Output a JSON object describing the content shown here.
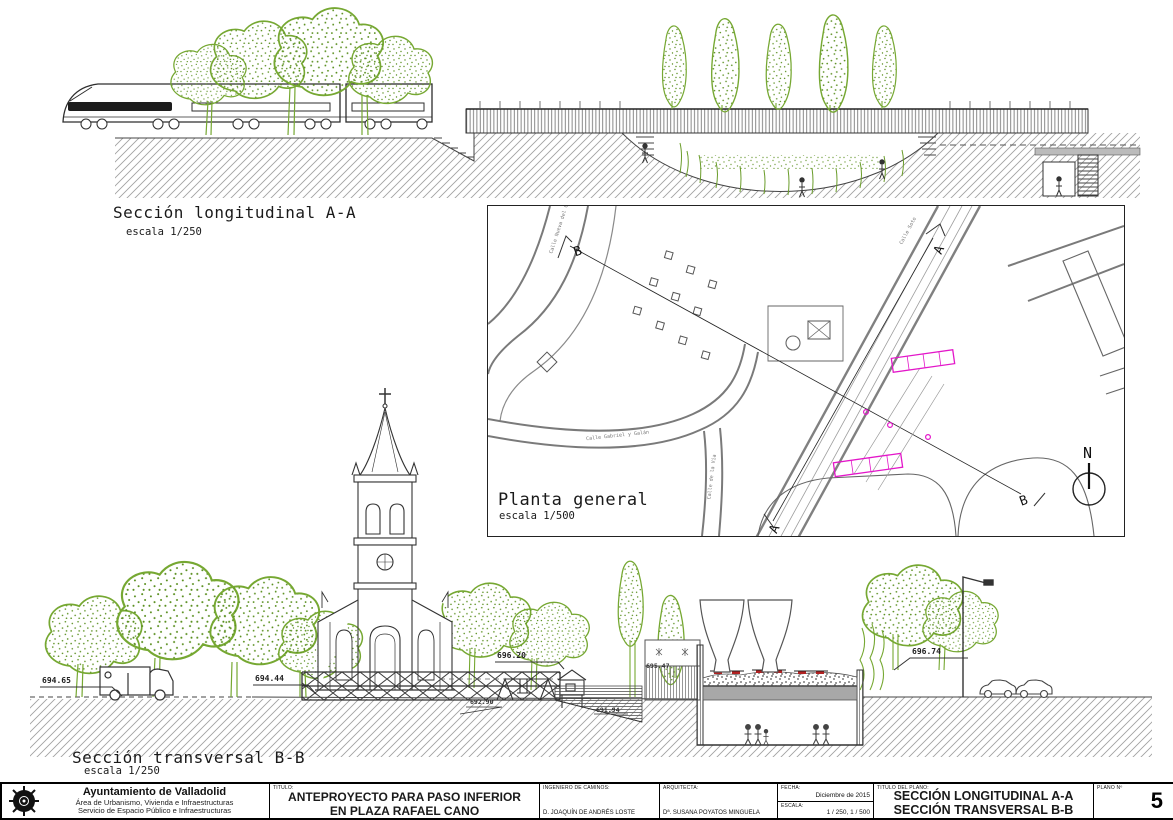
{
  "colors": {
    "green": "#76a832",
    "magenta": "#e316c9",
    "line": "#333333",
    "slab_gray": "#a8a8a8"
  },
  "sections": {
    "longitudinal": {
      "title": "Sección longitudinal A-A",
      "scale": "escala 1/250"
    },
    "planta": {
      "title": "Planta general",
      "scale": "escala 1/500"
    },
    "transversal": {
      "title": "Sección transversal B-B",
      "scale": "escala 1/250"
    }
  },
  "planta": {
    "streets": {
      "nueva_del_carmen": "Calle Nueva del Carmen",
      "soto": "Calle Soto",
      "gabriel_y_galan": "Calle Gabriel y Galán",
      "de_la_via": "Calle de la Vía"
    },
    "markers": {
      "a": "A",
      "b": "B"
    },
    "north": "N"
  },
  "elevations": {
    "left": "694.65",
    "street_left": "694.44",
    "deck_top": "696.20",
    "playground": "692.90",
    "stairs": "691.94",
    "deck_right": "695.47",
    "platform_right": "696.74"
  },
  "titleblock": {
    "org": {
      "name": "Ayuntamiento de Valladolid",
      "line2": "Área de Urbanismo, Vivienda e Infraestructuras",
      "line3": "Servicio de Espacio Público e Infraestructuras"
    },
    "titulo_label": "TITULO:",
    "titulo": [
      "ANTEPROYECTO PARA PASO INFERIOR",
      "EN PLAZA RAFAEL CANO"
    ],
    "ingeniero_label": "INGENIERO DE CAMINOS:",
    "ingeniero": "D. JOAQUÍN DE ANDRÉS LOSTE",
    "arquitecta_label": "ARQUITECTA:",
    "arquitecta": "Dª. SUSANA POYATOS MINGUELA",
    "fecha_label": "FECHA:",
    "fecha": "Diciembre de 2015",
    "escala_label": "ESCALA:",
    "escala": "1 / 250, 1 / 500",
    "plano_title_label": "TITULO DEL PLANO:",
    "plano_title": [
      "SECCIÓN LONGITUDINAL A-A",
      "SECCIÓN TRANSVERSAL B-B"
    ],
    "plano_num_label": "PLANO Nº",
    "plano_num": "5"
  }
}
